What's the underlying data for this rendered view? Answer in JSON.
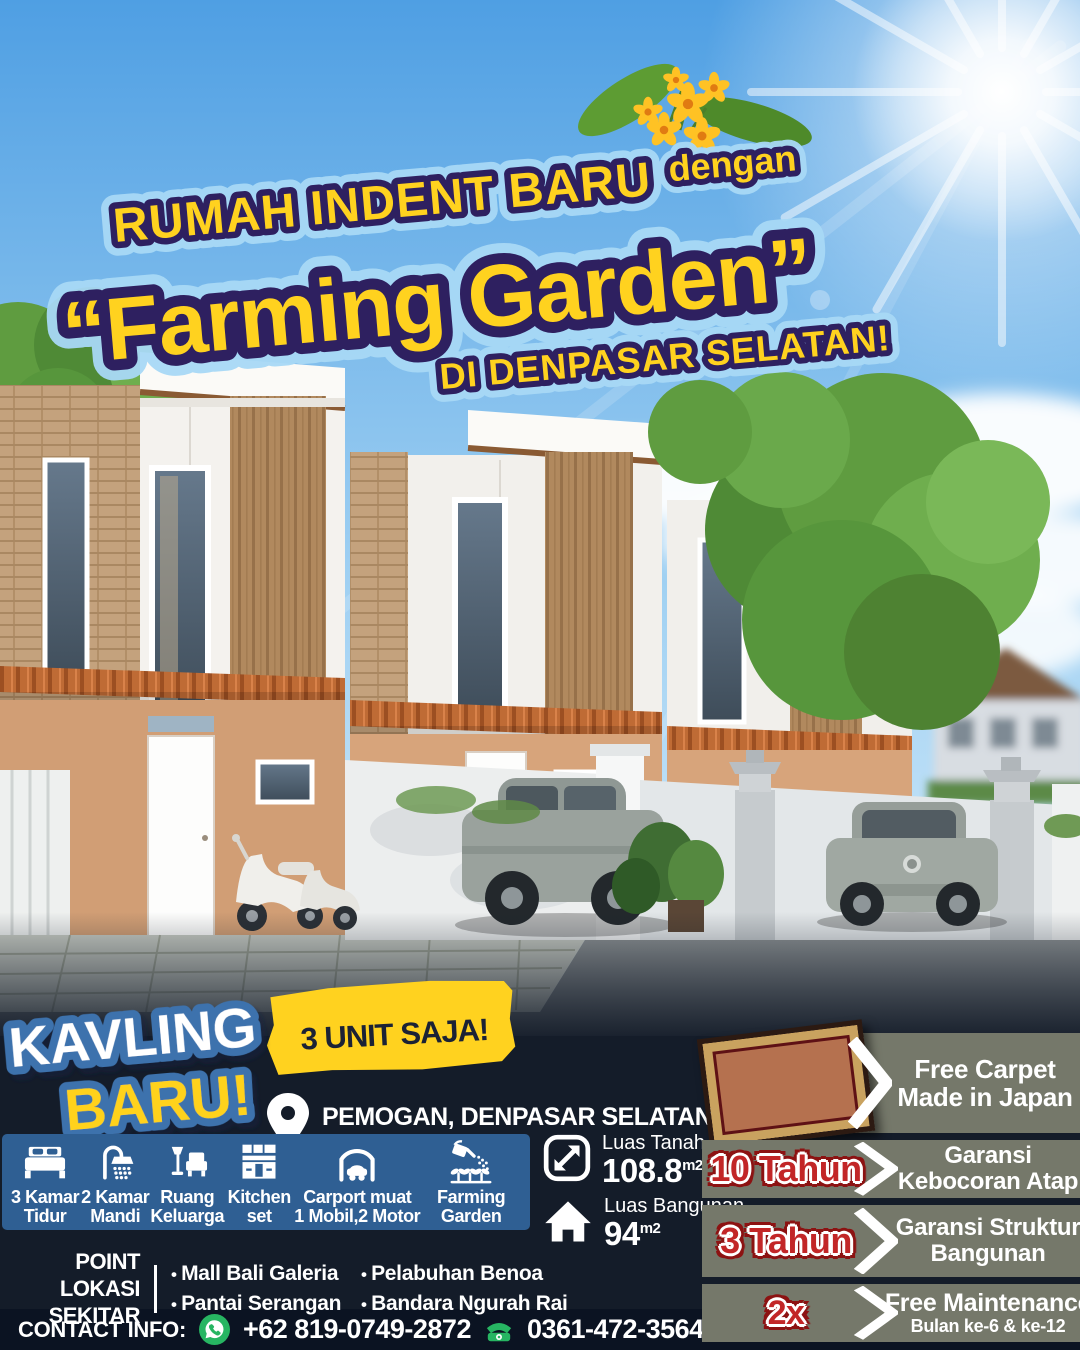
{
  "colors": {
    "yellow": "#ffd21f",
    "purple": "#2e2060",
    "glow_blue": "#a8d9f6",
    "badge_blue": "#3e72ad",
    "bar_blue": "#2f5f93",
    "navy": "#141c29",
    "navy_dark": "#0b1322",
    "panel_gray": "#75786a",
    "tag_red": "#c22627",
    "tag_red_dark": "#8c1212",
    "green": "#27b562"
  },
  "headline": {
    "line1": "RUMAH INDENT BARU",
    "connector": "dengan",
    "line2": "“Farming Garden”",
    "line3": "DI DENPASAR SELATAN!"
  },
  "promo": {
    "kavling": "KAVLING",
    "baru": "BARU!",
    "units": "3 UNIT SAJA!",
    "location": "PEMOGAN, DENPASAR SELATAN"
  },
  "features": [
    {
      "icon": "bed-icon",
      "line1": "3 Kamar",
      "line2": "Tidur"
    },
    {
      "icon": "shower-icon",
      "line1": "2 Kamar",
      "line2": "Mandi"
    },
    {
      "icon": "living-room-icon",
      "line1": "Ruang",
      "line2": "Keluarga"
    },
    {
      "icon": "kitchen-set-icon",
      "line1": "Kitchen",
      "line2": "set"
    },
    {
      "icon": "carport-icon",
      "line1": "Carport muat",
      "line2": "1 Mobil,2 Motor"
    },
    {
      "icon": "farming-garden-icon",
      "line1": "Farming",
      "line2": "Garden"
    }
  ],
  "specs": [
    {
      "icon": "land-area-icon",
      "label": "Luas Tanah",
      "value": "108.8",
      "unit": "m2"
    },
    {
      "icon": "building-area-icon",
      "label": "Luas Bangunan",
      "value": "94",
      "unit": "m2"
    }
  ],
  "nearby": {
    "title_line1": "POINT",
    "title_line2": "LOKASI SEKITAR",
    "column1": [
      "Mall Bali Galeria",
      "Pantai Serangan"
    ],
    "column2": [
      "Pelabuhan Benoa",
      "Bandara Ngurah Rai"
    ]
  },
  "contact": {
    "label": "CONTACT INFO:",
    "whatsapp": "+62 819-0749-2872",
    "phone": "0361-472-3564"
  },
  "benefits": [
    {
      "tag": "",
      "line1": "Free Carpet",
      "line2": "Made in Japan"
    },
    {
      "tag": "10 Tahun",
      "line1": "Garansi",
      "line2": "Kebocoran Atap"
    },
    {
      "tag": "3 Tahun",
      "line1": "Garansi Struktur",
      "line2": "Bangunan"
    },
    {
      "tag": "2x",
      "line1": "Free Maintenance",
      "line2": "Bulan ke-6 & ke-12"
    }
  ]
}
